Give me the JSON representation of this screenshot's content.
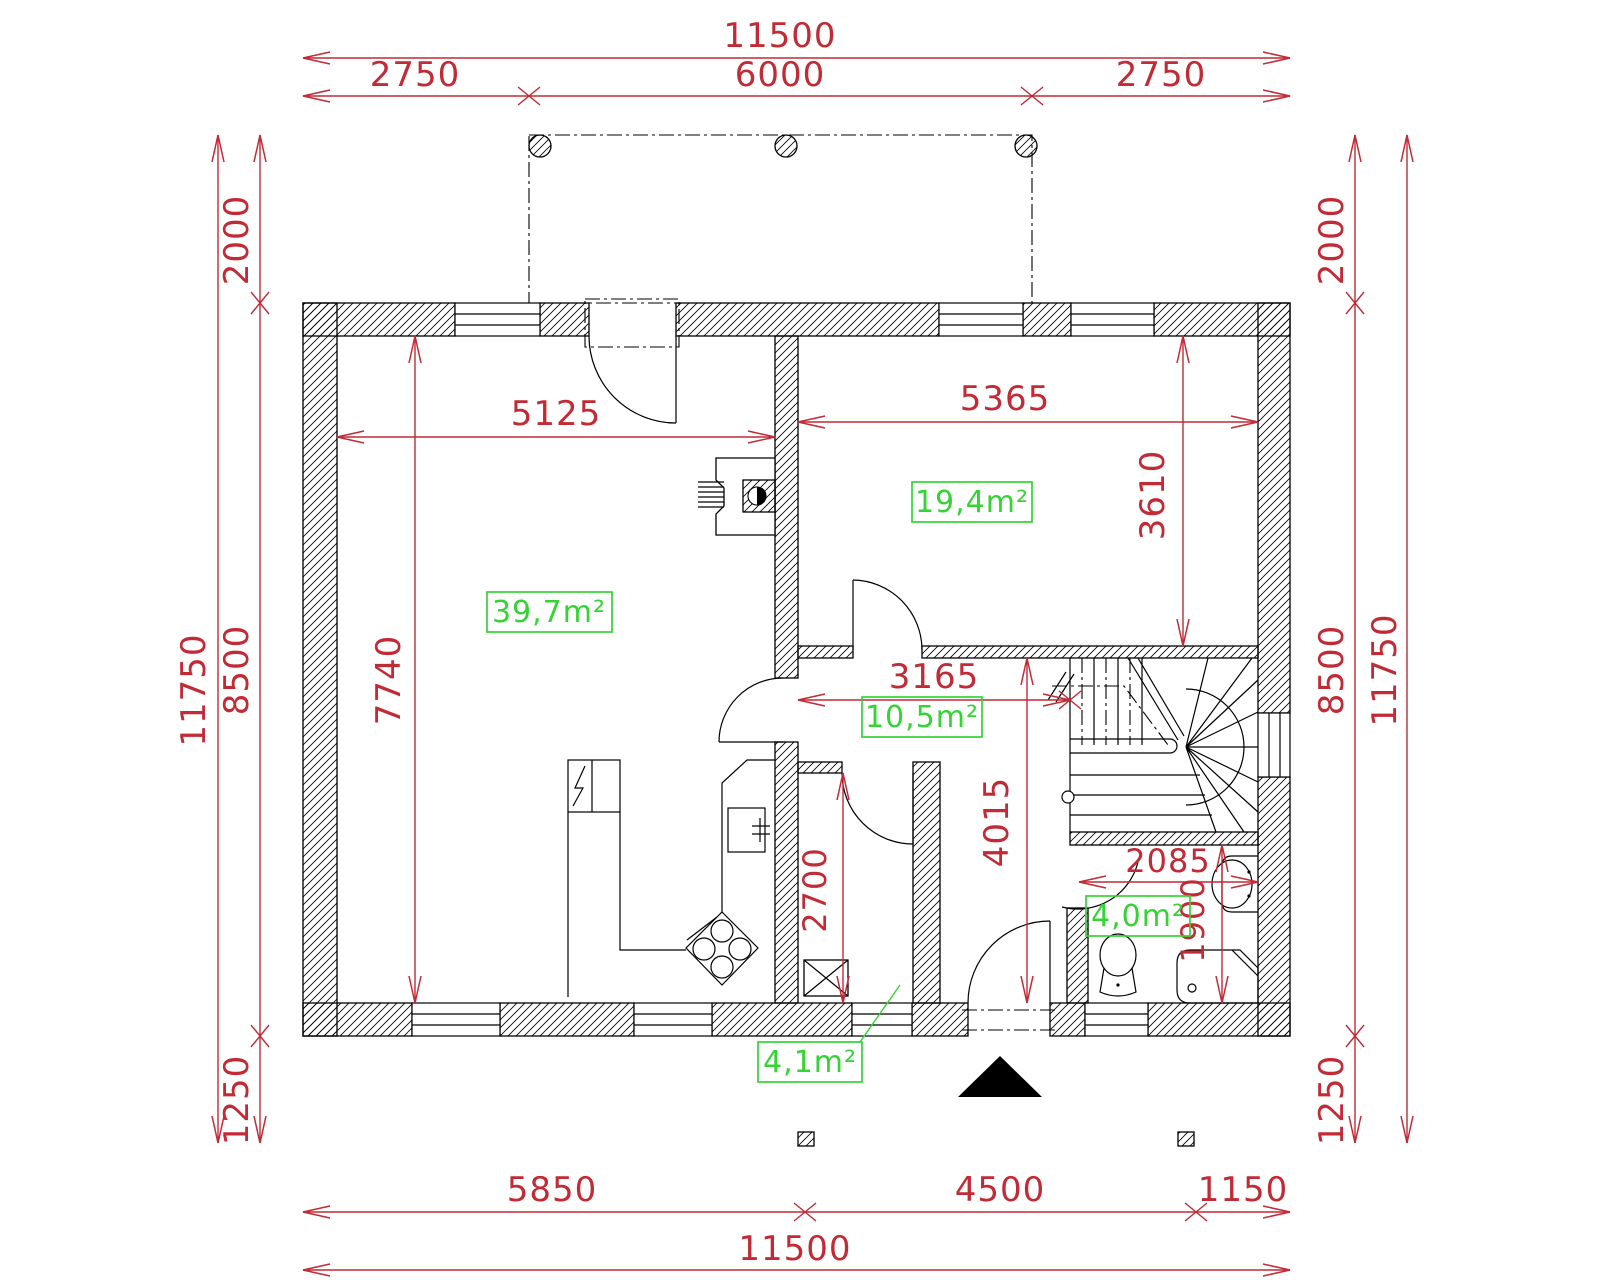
{
  "drawing_title": "ground-floor-plan",
  "colors": {
    "dimension": "#c22a35",
    "area_label": "#35d435",
    "line": "#000000",
    "background": "#ffffff"
  },
  "dims": {
    "top_overall": "11500",
    "top_left": "2750",
    "top_center": "6000",
    "top_right": "2750",
    "bottom_left": "5850",
    "bottom_center": "4500",
    "bottom_right": "1150",
    "bottom_overall": "11500",
    "left_terrace": "2000",
    "left_house": "8500",
    "left_porch": "1250",
    "left_overall": "11750",
    "right_terrace": "2000",
    "right_house": "8500",
    "right_porch": "1250",
    "right_overall": "11750",
    "living_width": "5125",
    "living_depth": "7740",
    "room_width": "5365",
    "room_depth": "3610",
    "hall_width": "3165",
    "hall_depth": "4015",
    "pantry_depth": "2700",
    "bath_width": "2085",
    "bath_depth": "1900"
  },
  "areas": {
    "living": "39,7m²",
    "room": "19,4m²",
    "hall": "10,5m²",
    "bath": "4,0m²",
    "pantry": "4,1m²"
  }
}
